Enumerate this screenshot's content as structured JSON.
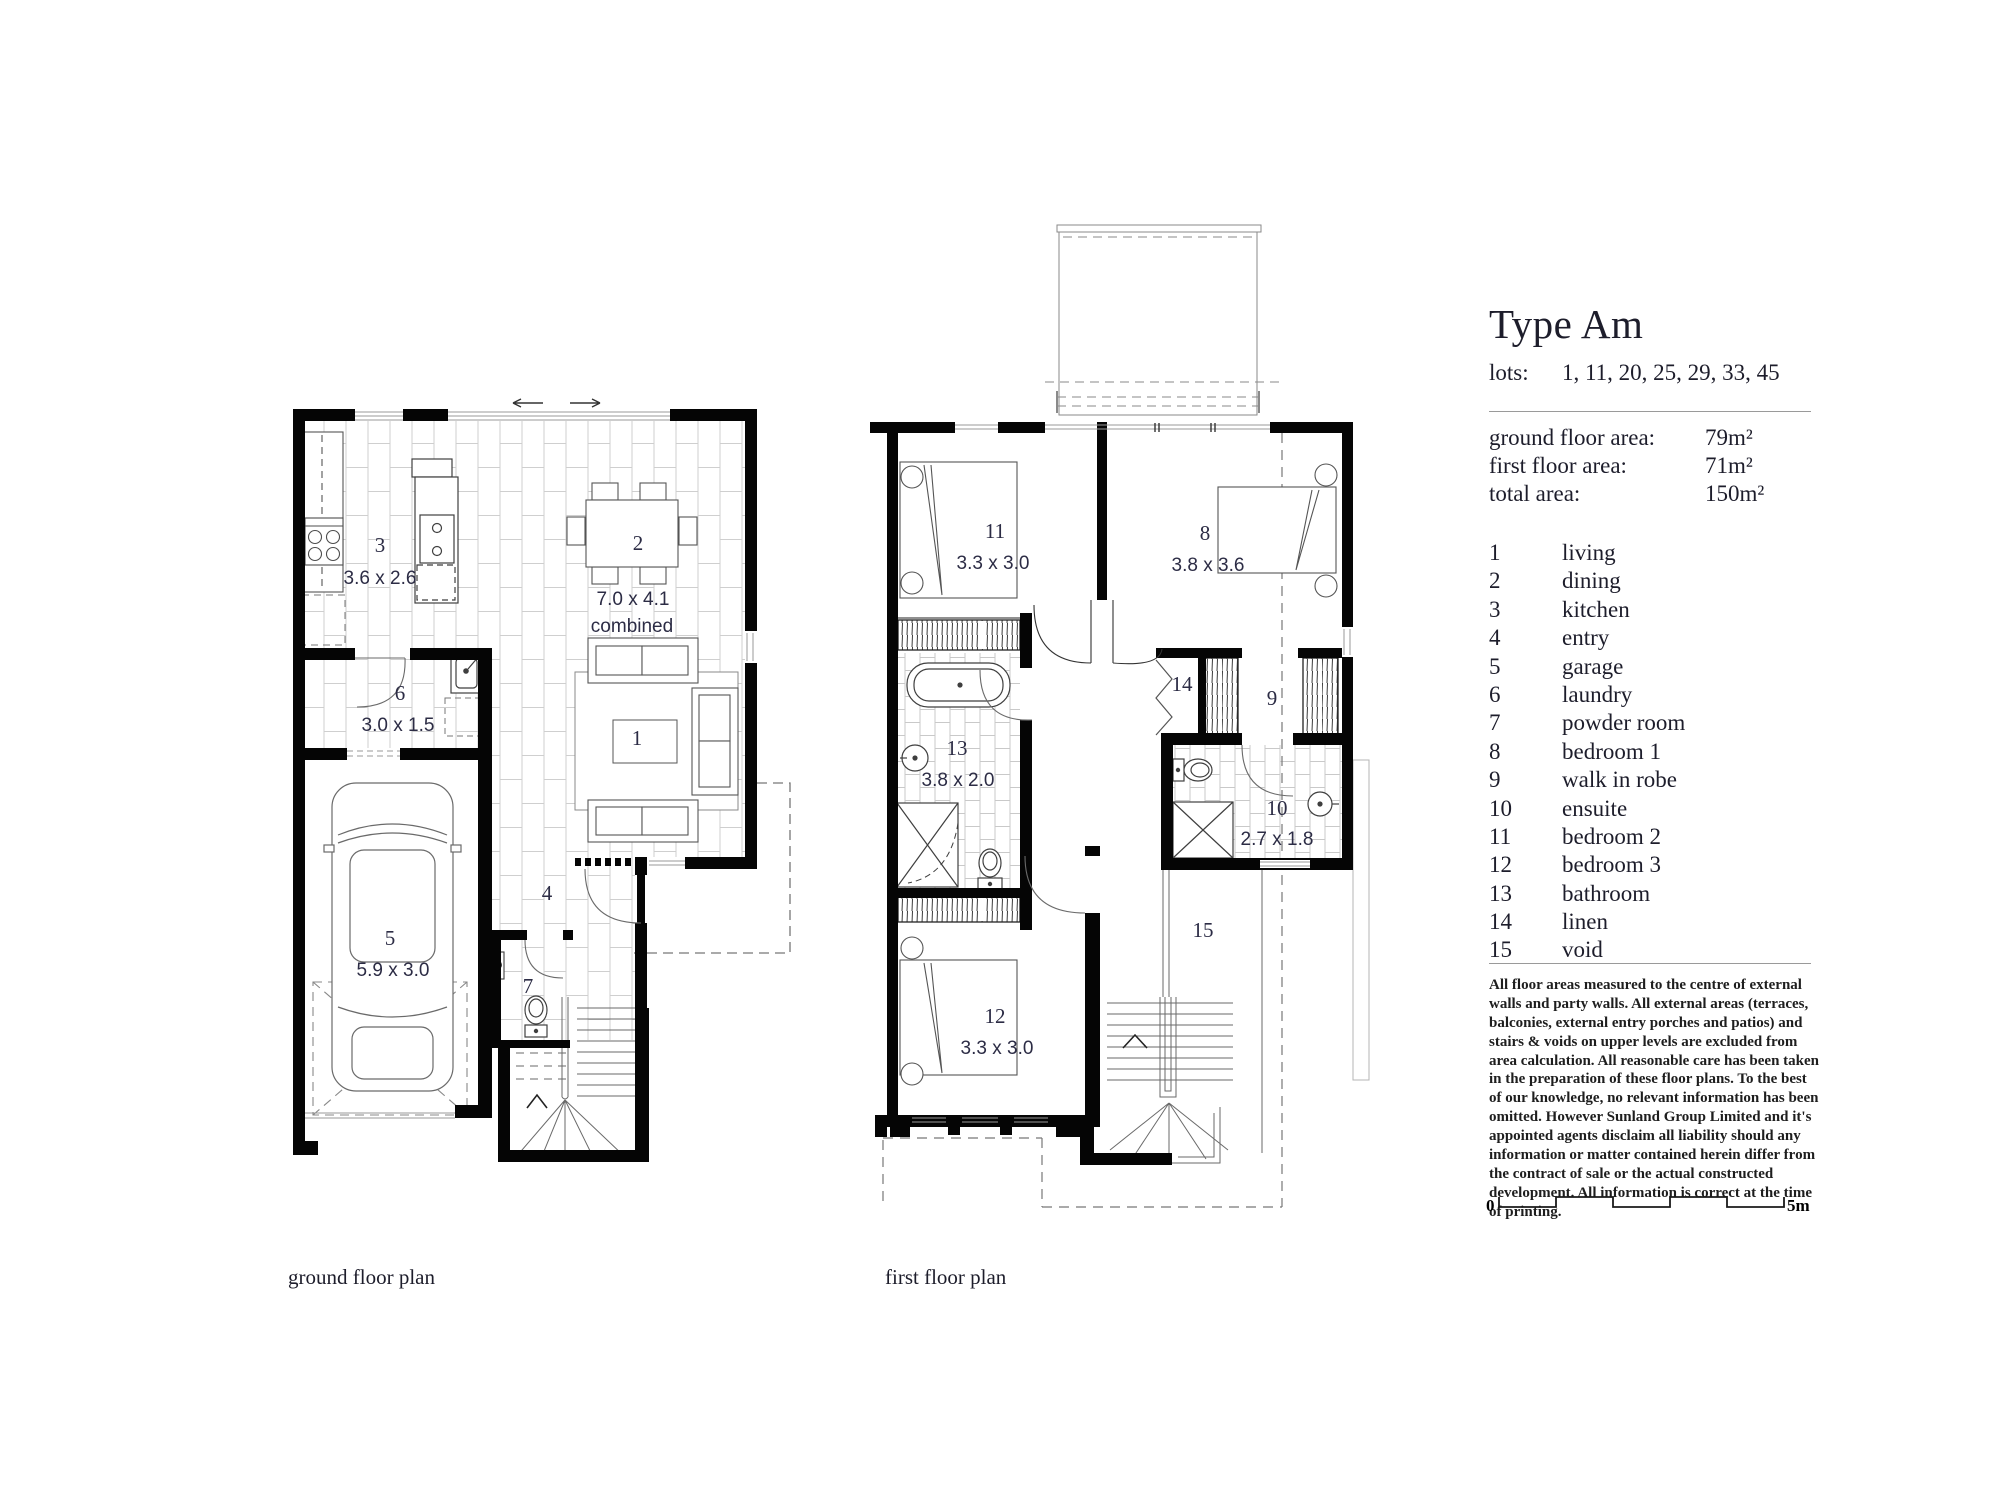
{
  "panel": {
    "title": "Type Am",
    "lots_label": "lots:",
    "lots_values": "1, 11, 20, 25, 29, 33, 45",
    "areas": [
      {
        "label": "ground floor area:",
        "value": "79m²"
      },
      {
        "label": "first floor area:",
        "value": "71m²"
      },
      {
        "label": "total area:",
        "value": "150m²"
      }
    ],
    "rooms": [
      {
        "num": "1",
        "name": "living"
      },
      {
        "num": "2",
        "name": "dining"
      },
      {
        "num": "3",
        "name": "kitchen"
      },
      {
        "num": "4",
        "name": "entry"
      },
      {
        "num": "5",
        "name": "garage"
      },
      {
        "num": "6",
        "name": "laundry"
      },
      {
        "num": "7",
        "name": "powder room"
      },
      {
        "num": "8",
        "name": "bedroom 1"
      },
      {
        "num": "9",
        "name": "walk in robe"
      },
      {
        "num": "10",
        "name": "ensuite"
      },
      {
        "num": "11",
        "name": "bedroom 2"
      },
      {
        "num": "12",
        "name": "bedroom 3"
      },
      {
        "num": "13",
        "name": "bathroom"
      },
      {
        "num": "14",
        "name": "linen"
      },
      {
        "num": "15",
        "name": "void"
      }
    ],
    "disclaimer": "All floor areas measured to the centre of external walls and party walls. All external areas (terraces, balconies, external entry porches and patios) and stairs & voids on upper levels are excluded from area calculation. All reasonable care has been taken in the preparation of these floor plans. To the best of our knowledge, no relevant information has been omitted. However Sunland Group Limited and it's appointed agents disclaim all liability should any information or matter contained herein differ from the contract of sale or the actual constructed development. All information is correct at the time of printing.",
    "scale": {
      "start": "0",
      "end": "5m"
    }
  },
  "ground_floor": {
    "caption": "ground floor plan",
    "labels": {
      "living_num": "1",
      "dining_num": "2",
      "dining_dim": "7.0 x 4.1",
      "dining_note": "combined",
      "kitchen_num": "3",
      "kitchen_dim": "3.6 x 2.6",
      "entry_num": "4",
      "garage_num": "5",
      "garage_dim": "5.9 x 3.0",
      "laundry_num": "6",
      "laundry_dim": "3.0 x 1.5",
      "powder_num": "7"
    }
  },
  "first_floor": {
    "caption": "first floor plan",
    "labels": {
      "bed1_num": "8",
      "bed1_dim": "3.8 x 3.6",
      "robe_num": "9",
      "ensuite_num": "10",
      "ensuite_dim": "2.7 x 1.8",
      "bed2_num": "11",
      "bed2_dim": "3.3 x 3.0",
      "bed3_num": "12",
      "bed3_dim": "3.3 x 3.0",
      "bath_num": "13",
      "bath_dim": "3.8 x 2.0",
      "linen_num": "14",
      "void_num": "15"
    }
  }
}
